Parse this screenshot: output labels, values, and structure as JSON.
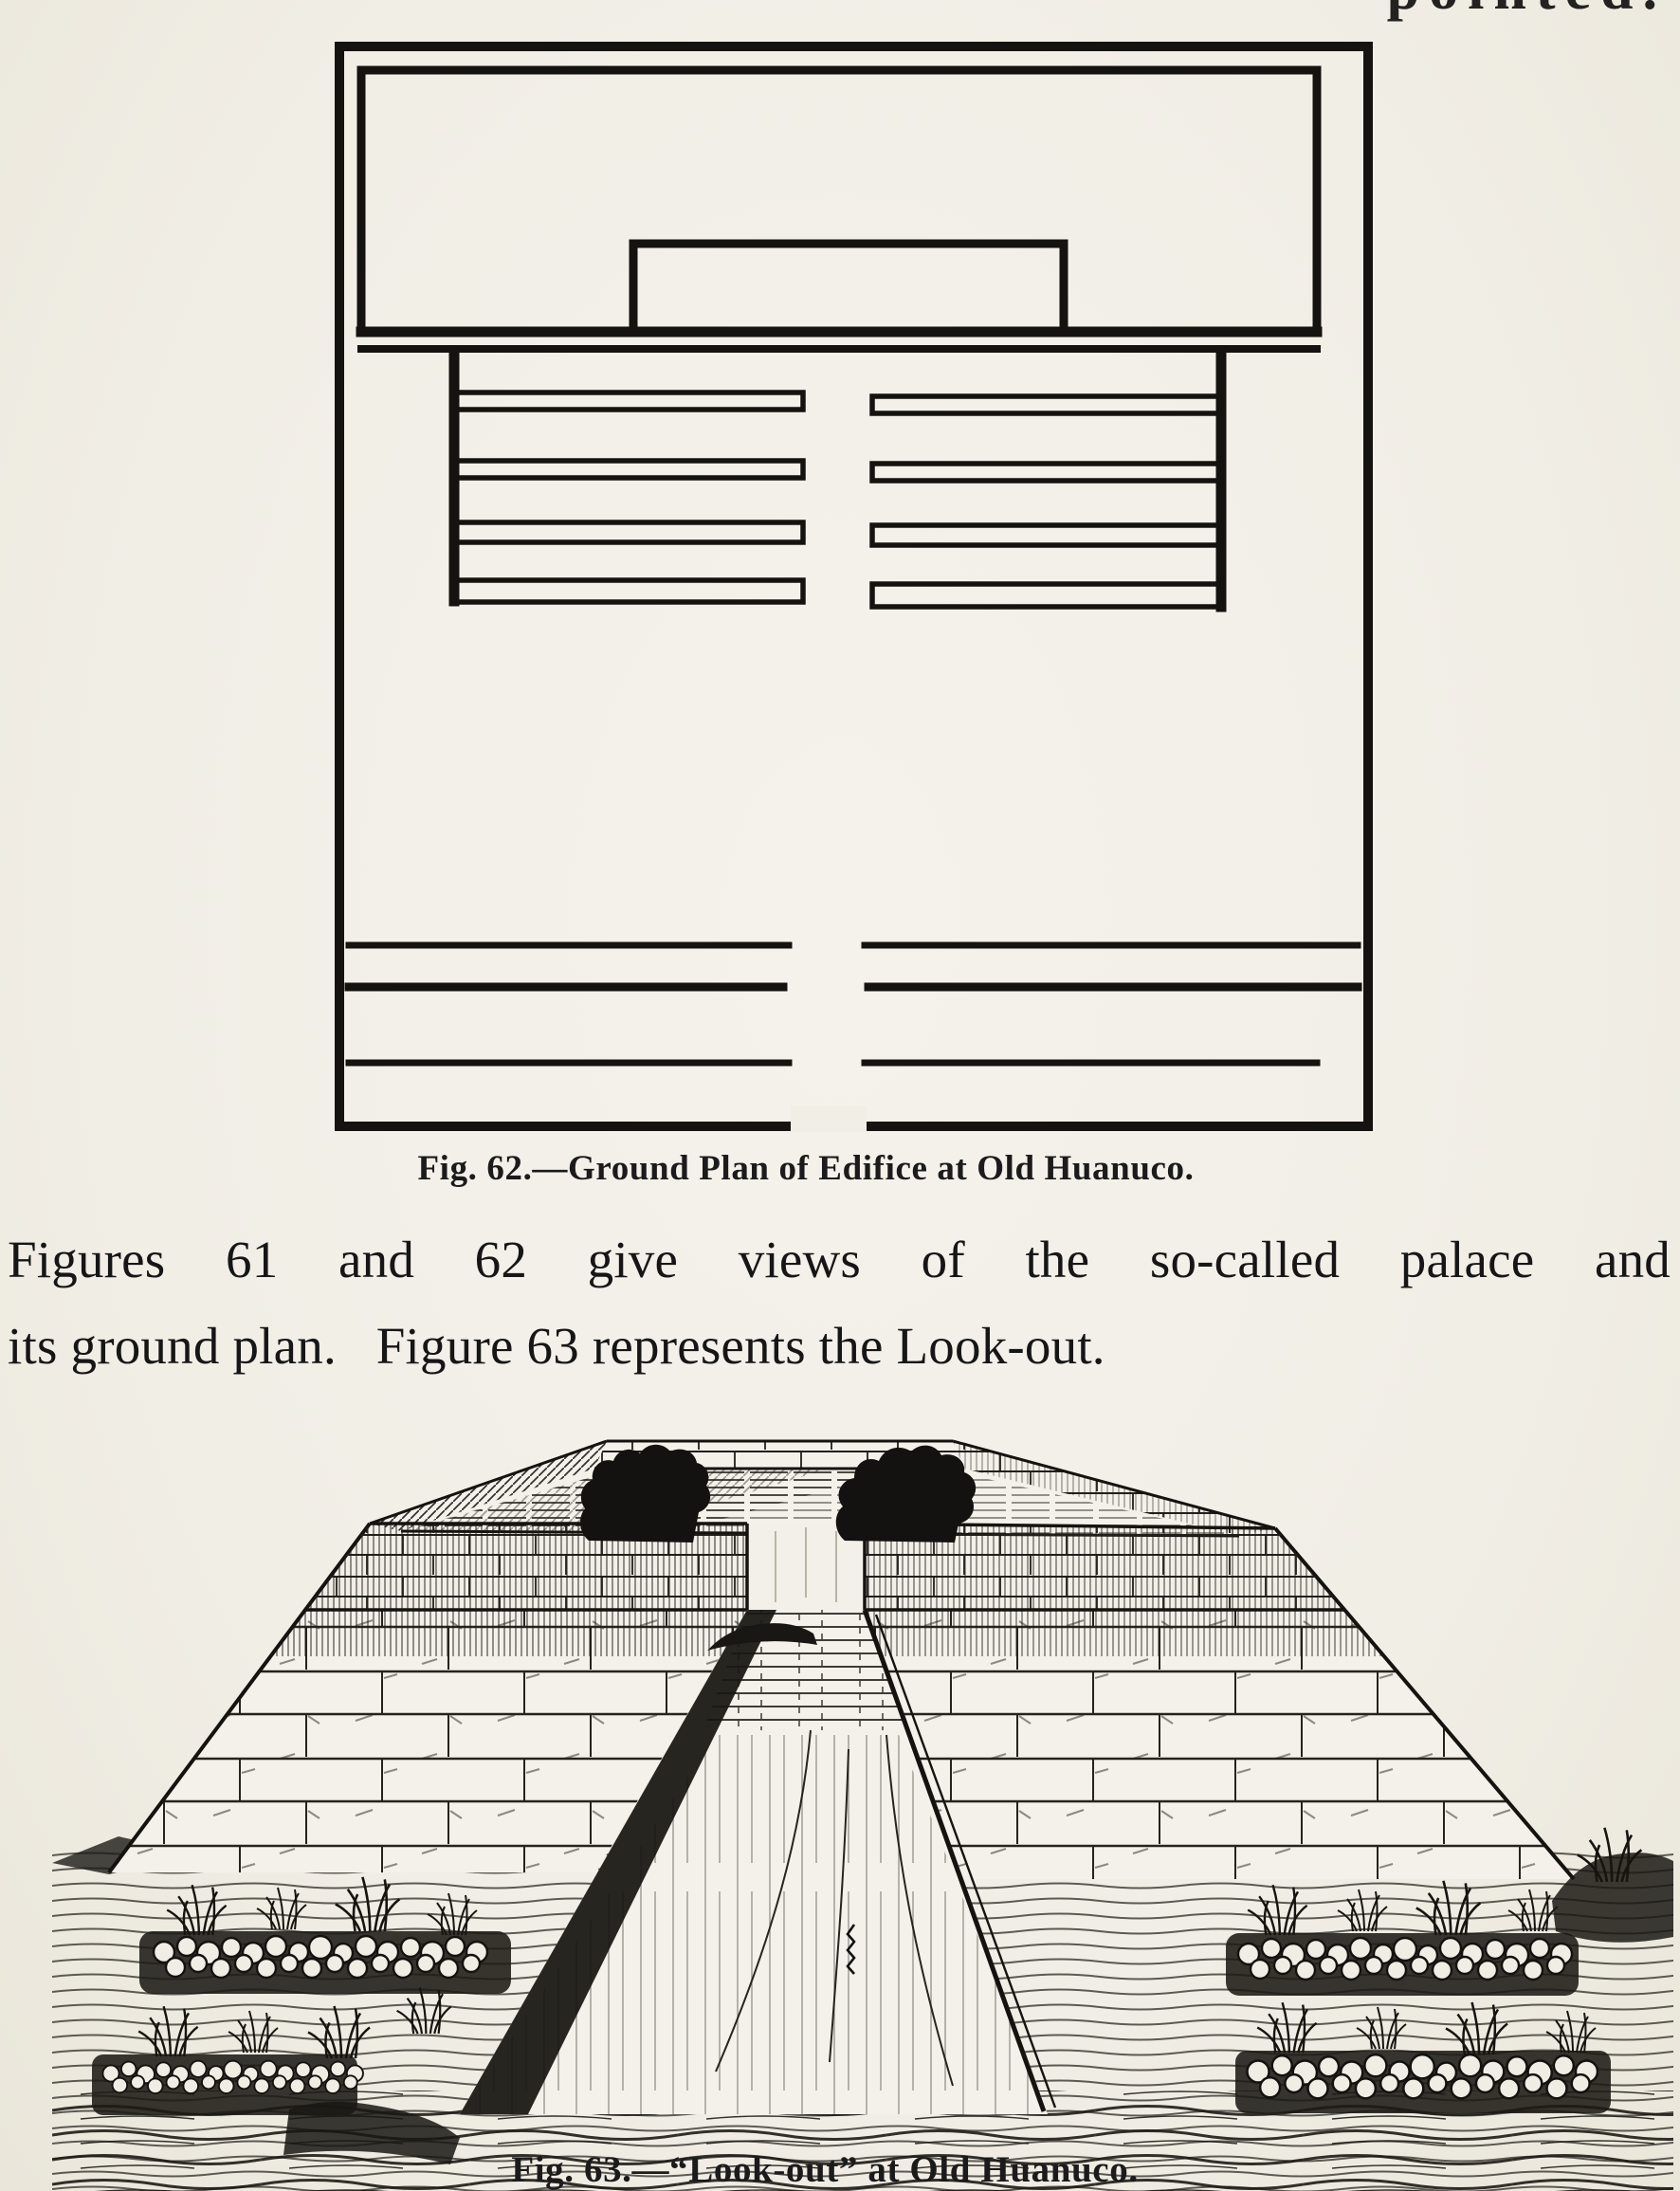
{
  "page": {
    "paper_color": "#f1eee6",
    "ink_color": "#1a1a1a",
    "top_fragment": "pointed.",
    "figure62": {
      "caption": "Fig. 62.—Ground Plan of Edifice at Old Huanuco."
    },
    "paragraph": {
      "line1": "Figures 61 and 62 give views of the so-called palace and",
      "line2": "its ground plan.   Figure 63 represents the Look-out."
    },
    "figure63": {
      "caption": "Fig. 63.—“Look-out” at Old Huanuco."
    }
  }
}
